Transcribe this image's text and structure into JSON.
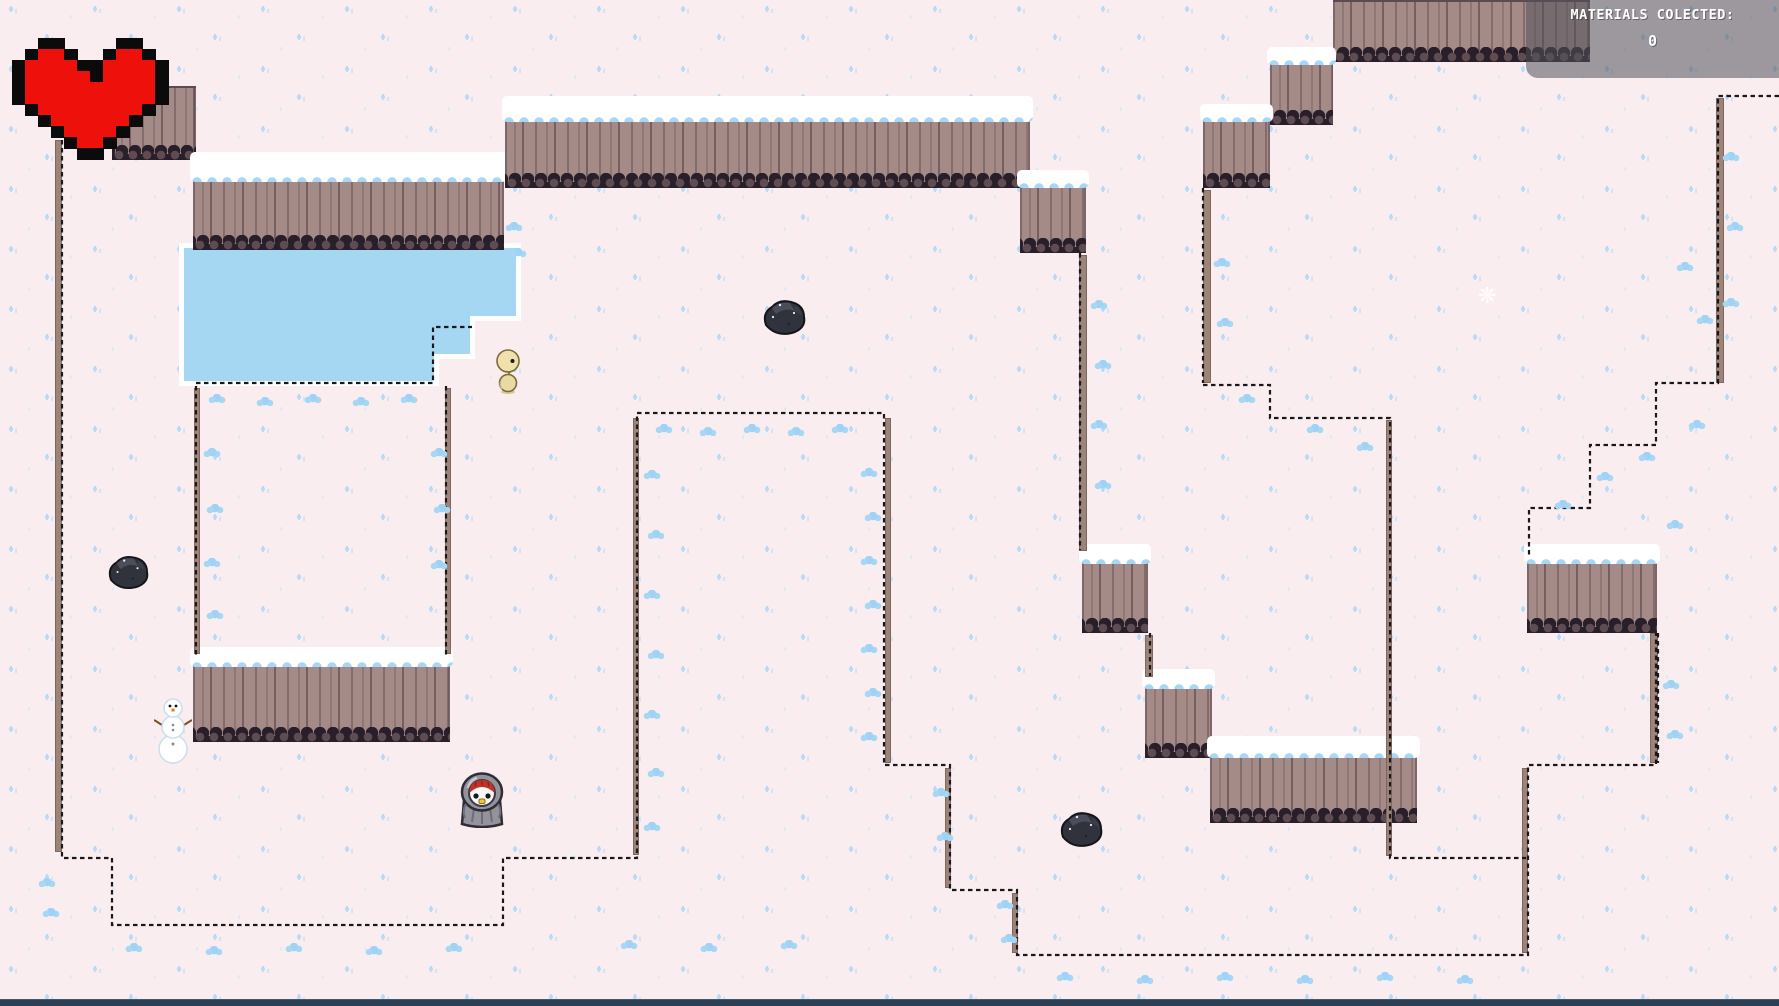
{
  "hud": {
    "materials_label": "MATERIALS COLECTED:",
    "materials_value": "0"
  },
  "colors": {
    "snow": "#FAEDEF",
    "speckle": "#B7DAF6",
    "water": "#A6D7F2",
    "water_rim": "#FFFFFF",
    "cliff_face": "#A48B87",
    "cliff_dark_edge": "#281F2B",
    "ice_clump": "#A6D7F5",
    "heart_red": "#EE100B",
    "heart_outline": "#0B0B0B",
    "panel_bg": "rgba(80,82,90,0.55)",
    "panel_text": "#FFFFFF",
    "bottom_bar": "#2B4054",
    "dotted_line": "#19191C"
  },
  "panel": {
    "x": 1526,
    "y": 0,
    "w": 253,
    "h": 78
  },
  "terrain": {
    "cliffs": [
      [
        112,
        86,
        84,
        74,
        0
      ],
      [
        193,
        158,
        311,
        92,
        24
      ],
      [
        505,
        102,
        525,
        86,
        20
      ],
      [
        1020,
        176,
        66,
        77,
        12
      ],
      [
        1082,
        550,
        66,
        83,
        14
      ],
      [
        1145,
        675,
        67,
        83,
        14
      ],
      [
        1210,
        742,
        207,
        81,
        16
      ],
      [
        1333,
        0,
        257,
        62,
        0
      ],
      [
        1270,
        53,
        63,
        72,
        12
      ],
      [
        1203,
        110,
        67,
        78,
        12
      ],
      [
        1527,
        550,
        130,
        83,
        14
      ],
      [
        193,
        653,
        257,
        89,
        14
      ]
    ],
    "slivers": [
      [
        55,
        140,
        7,
        712
      ],
      [
        633,
        418,
        6,
        437
      ],
      [
        885,
        418,
        6,
        345
      ],
      [
        945,
        768,
        6,
        120
      ],
      [
        1012,
        893,
        6,
        60
      ],
      [
        1386,
        420,
        6,
        436
      ],
      [
        1522,
        768,
        6,
        185
      ],
      [
        1650,
        633,
        8,
        130
      ],
      [
        1079,
        255,
        8,
        296
      ],
      [
        1145,
        635,
        8,
        42
      ],
      [
        1203,
        190,
        8,
        193
      ],
      [
        1716,
        98,
        8,
        285
      ],
      [
        194,
        388,
        6,
        266
      ],
      [
        445,
        388,
        6,
        266
      ]
    ],
    "dotted": [
      "M62,132 V858 H112 V925 H503 V858 H637 V413 H884 V765 H950 V890 H1017 V955 H1528 V765 H1656 V633",
      "M196,386 V656",
      "M446,386 V656",
      "M196,383 H433 V327 H472",
      "M1203,188 V383",
      "M1203,385 H1270 V418 H1390 V858 H1526",
      "M1779,96 H1718 V383 H1656 V445 H1590 V508 H1529 V556",
      "M1080,253 V550",
      "M1150,633 V676",
      "M1658,633 V763"
    ]
  },
  "pond": {
    "outer": "179,243 521,243 521,321 475,321 475,359 439,359 439,386 179,386",
    "inner": "184,248 516,248 516,316 470,316 470,354 434,354 434,381 184,381"
  },
  "decor": {
    "clumps": [
      [
        655,
        424
      ],
      [
        699,
        427
      ],
      [
        743,
        424
      ],
      [
        787,
        427
      ],
      [
        831,
        424
      ],
      [
        860,
        468
      ],
      [
        864,
        512
      ],
      [
        860,
        556
      ],
      [
        864,
        600
      ],
      [
        860,
        644
      ],
      [
        864,
        688
      ],
      [
        860,
        732
      ],
      [
        643,
        470
      ],
      [
        647,
        530
      ],
      [
        643,
        590
      ],
      [
        647,
        650
      ],
      [
        643,
        710
      ],
      [
        647,
        768
      ],
      [
        643,
        822
      ],
      [
        208,
        394
      ],
      [
        256,
        397
      ],
      [
        304,
        394
      ],
      [
        352,
        397
      ],
      [
        400,
        394
      ],
      [
        203,
        448
      ],
      [
        206,
        504
      ],
      [
        203,
        558
      ],
      [
        206,
        610
      ],
      [
        430,
        448
      ],
      [
        433,
        504
      ],
      [
        430,
        560
      ],
      [
        932,
        788
      ],
      [
        936,
        832
      ],
      [
        996,
        900
      ],
      [
        1000,
        934
      ],
      [
        1056,
        972
      ],
      [
        1136,
        975
      ],
      [
        1216,
        972
      ],
      [
        1296,
        975
      ],
      [
        1376,
        972
      ],
      [
        1456,
        975
      ],
      [
        125,
        943
      ],
      [
        205,
        946
      ],
      [
        285,
        943
      ],
      [
        365,
        946
      ],
      [
        445,
        943
      ],
      [
        620,
        940
      ],
      [
        700,
        943
      ],
      [
        780,
        940
      ],
      [
        38,
        878
      ],
      [
        42,
        908
      ],
      [
        1090,
        300
      ],
      [
        1094,
        360
      ],
      [
        1090,
        420
      ],
      [
        1094,
        480
      ],
      [
        1213,
        258
      ],
      [
        1216,
        318
      ],
      [
        1722,
        152
      ],
      [
        1726,
        222
      ],
      [
        1722,
        298
      ],
      [
        1238,
        394
      ],
      [
        1306,
        424
      ],
      [
        1356,
        442
      ],
      [
        1638,
        452
      ],
      [
        1596,
        472
      ],
      [
        1554,
        500
      ],
      [
        1676,
        262
      ],
      [
        1696,
        315
      ],
      [
        1688,
        420
      ],
      [
        1666,
        520
      ],
      [
        1662,
        680
      ],
      [
        1666,
        730
      ],
      [
        505,
        222
      ],
      [
        509,
        248
      ]
    ],
    "sparkles": [
      [
        1478,
        286
      ]
    ]
  },
  "sprites": {
    "heart": {
      "x": 12,
      "y": 38,
      "cell_w": 13,
      "cell_h": 11,
      "pixels": [
        "..XX....XX..",
        ".XRRX..XRRX.",
        "XRRRRXXRRRRX",
        "XRRRRRXRRRRX",
        "XRRRRRRRRRRX",
        "XRRRRRRRRRRX",
        ".XRRRRRRRRX.",
        "..XRRRRRRX..",
        "...XRRRRX...",
        "....XRRX....",
        ".....XX....."
      ]
    },
    "player": {
      "x": 456,
      "y": 770,
      "w": 52,
      "h": 58
    },
    "duck": {
      "x": 494,
      "y": 348,
      "w": 30,
      "h": 46
    },
    "snowman": {
      "x": 154,
      "y": 696,
      "w": 38,
      "h": 68
    },
    "rocks": [
      [
        104,
        552,
        48,
        40
      ],
      [
        758,
        296,
        52,
        42
      ],
      [
        1056,
        808,
        50,
        42
      ]
    ]
  }
}
